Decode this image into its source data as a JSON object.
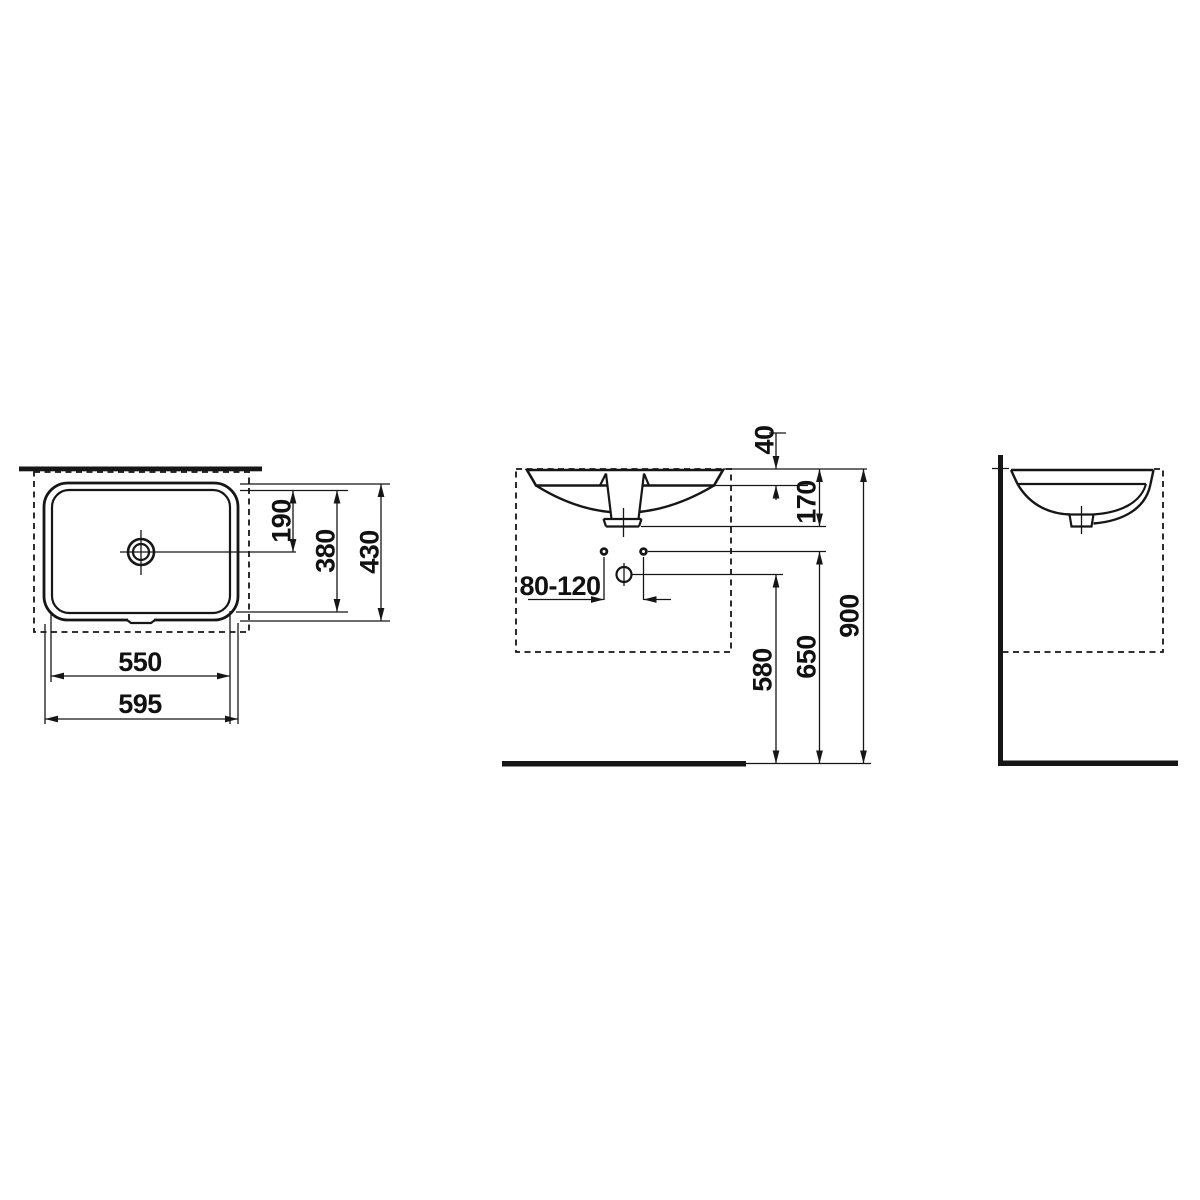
{
  "drawing": {
    "type": "technical-dimension-drawing",
    "subject": "undercounter washbasin, three orthographic views",
    "background": "#ffffff",
    "line_color": "#161616",
    "views": {
      "plan": {
        "name": "top view"
      },
      "front": {
        "name": "front view"
      },
      "side": {
        "name": "side view"
      }
    },
    "dimensions": {
      "plan": {
        "bowl_width": "550",
        "overall_width": "595",
        "drain_offset": "190",
        "bowl_depth": "380",
        "overall_depth": "430"
      },
      "front": {
        "tap_hole_spacing": "80-120",
        "rim_thickness": "40",
        "outlet_drop": "170",
        "rim_height": "900",
        "supply_height": "650",
        "waste_height": "580"
      }
    }
  }
}
